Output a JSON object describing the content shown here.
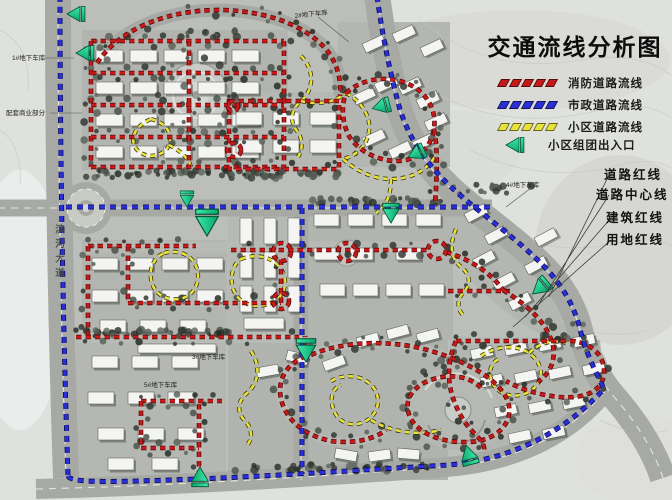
{
  "title": "交通流线分析图",
  "colors": {
    "fire_route": "#c41a1a",
    "municipal_route": "#2a2fd4",
    "district_route": "#e8e23c",
    "entrance": "#10d18c"
  },
  "legend": {
    "items": [
      {
        "id": "fire",
        "label": "消防道路流线"
      },
      {
        "id": "municipal",
        "label": "市政道路流线"
      },
      {
        "id": "district",
        "label": "小区道路流线"
      },
      {
        "id": "entrance",
        "label": "小区组团出入口"
      }
    ]
  },
  "annotations": {
    "items": [
      {
        "label": "道路红线"
      },
      {
        "label": "道路中心线"
      },
      {
        "label": "建筑红线"
      },
      {
        "label": "用地红线"
      }
    ]
  },
  "map_labels": {
    "garage1": "1#地下车库",
    "commercial": "配套商业部分",
    "garage2": "2#地下车库",
    "garage3": "3#地下车库",
    "garage4": "4#地下车库",
    "garage5": "5#地下车库",
    "road_name": "滨河大道"
  }
}
